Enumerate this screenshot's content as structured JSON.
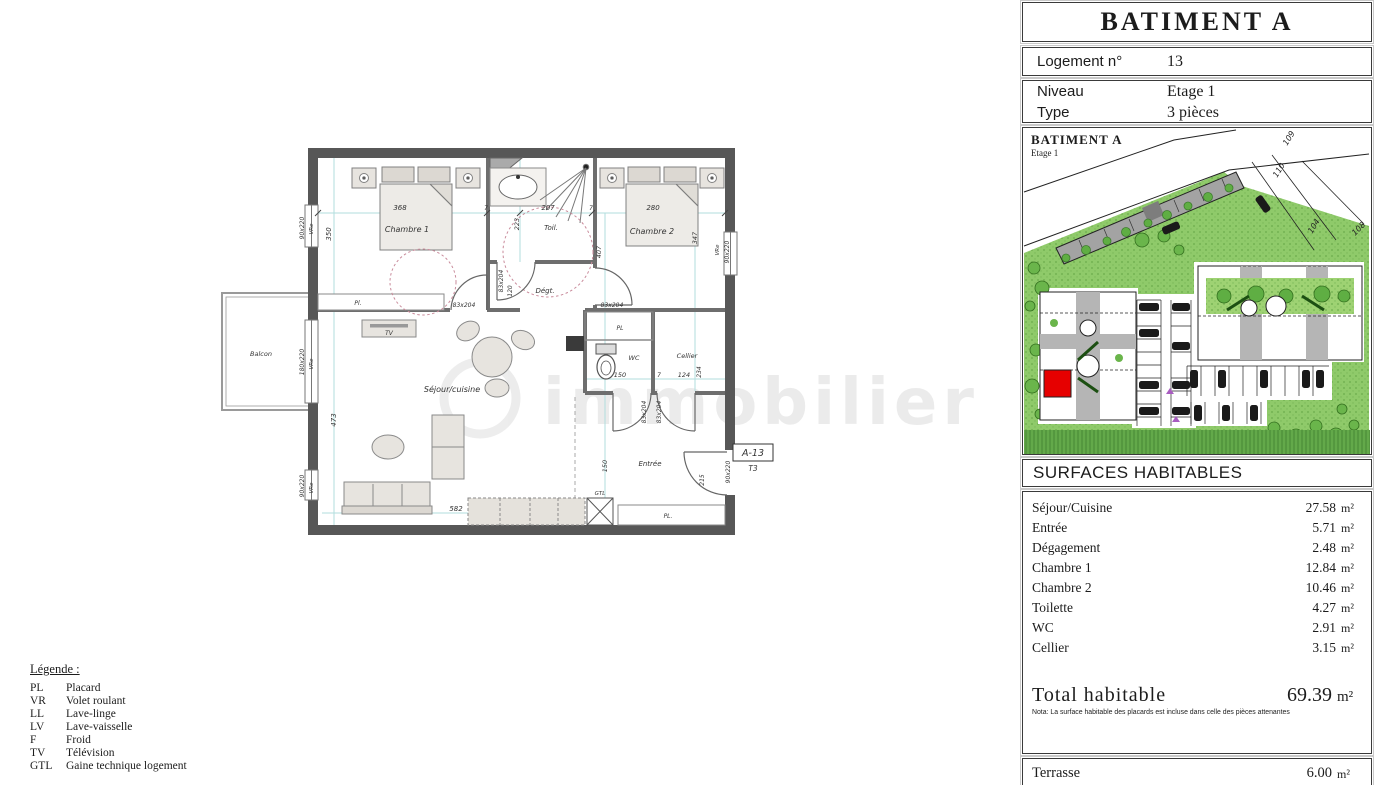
{
  "sheet": {
    "header": {
      "building": "BATIMENT A",
      "logement_label": "Logement n°",
      "logement_value": "13",
      "niveau_label": "Niveau",
      "niveau_value": "Etage 1",
      "type_label": "Type",
      "type_value": "3 pièces"
    },
    "siteplan": {
      "title": "BATIMENT A",
      "subtitle": "Etage 1",
      "parcels": [
        "109",
        "110",
        "104",
        "108"
      ]
    },
    "surfaces": {
      "title": "SURFACES HABITABLES",
      "unit": "m²",
      "rows": [
        {
          "label": "Séjour/Cuisine",
          "value": "27.58"
        },
        {
          "label": "Entrée",
          "value": "5.71"
        },
        {
          "label": "Dégagement",
          "value": "2.48"
        },
        {
          "label": "Chambre 1",
          "value": "12.84"
        },
        {
          "label": "Chambre 2",
          "value": "10.46"
        },
        {
          "label": "Toilette",
          "value": "4.27"
        },
        {
          "label": "WC",
          "value": "2.91"
        },
        {
          "label": "Cellier",
          "value": "3.15"
        }
      ],
      "total_label": "Total habitable",
      "total_value": "69.39",
      "nota": "Nota: La surface habitable des placards est incluse dans celle des pièces attenantes",
      "terrasse_label": "Terrasse",
      "terrasse_value": "6.00"
    }
  },
  "legend": {
    "title": "Légende :",
    "items": [
      {
        "abbr": "PL",
        "label": "Placard"
      },
      {
        "abbr": "VR",
        "label": "Volet roulant"
      },
      {
        "abbr": "LL",
        "label": "Lave-linge"
      },
      {
        "abbr": "LV",
        "label": "Lave-vaisselle"
      },
      {
        "abbr": "F",
        "label": "Froid"
      },
      {
        "abbr": "TV",
        "label": "Télévision"
      },
      {
        "abbr": "GTL",
        "label": "Gaine technique logement"
      }
    ]
  },
  "plan": {
    "rooms": {
      "chambre1": "Chambre 1",
      "chambre2": "Chambre 2",
      "toilette": "Toil.",
      "degagement": "Dégt.",
      "sejour": "Séjour/cuisine",
      "entree": "Entrée",
      "wc": "WC",
      "cellier": "Cellier",
      "balcon": "Balcon",
      "placard_upper": "PL",
      "placard_small": "Pl.",
      "placard_entree": "PL.",
      "gtl": "GTL",
      "tv": "TV"
    },
    "dims": {
      "chambre1_width": "368",
      "toil_width": "207",
      "chambre2_width": "280",
      "toil_depth": "223",
      "chambre1_height": "350",
      "sejour_height": "473",
      "sejour_width": "582",
      "chambre2_height": "347",
      "chambre2_depth": "407",
      "wc_width": "150",
      "entree_width": "150",
      "entree_side": "215",
      "cellier_width": "124",
      "cellier_depth": "234",
      "deg_width": "120",
      "gap": "7",
      "door": "83x204",
      "window_small": "90x220",
      "window_large": "180x220",
      "shutter": "VRe"
    },
    "tag": {
      "code": "A-13",
      "type": "T3"
    },
    "watermark": "immobilier"
  },
  "colors": {
    "highlight_red": "#e60000",
    "site_green": "#8fca6a",
    "wall_gray": "#575757"
  }
}
